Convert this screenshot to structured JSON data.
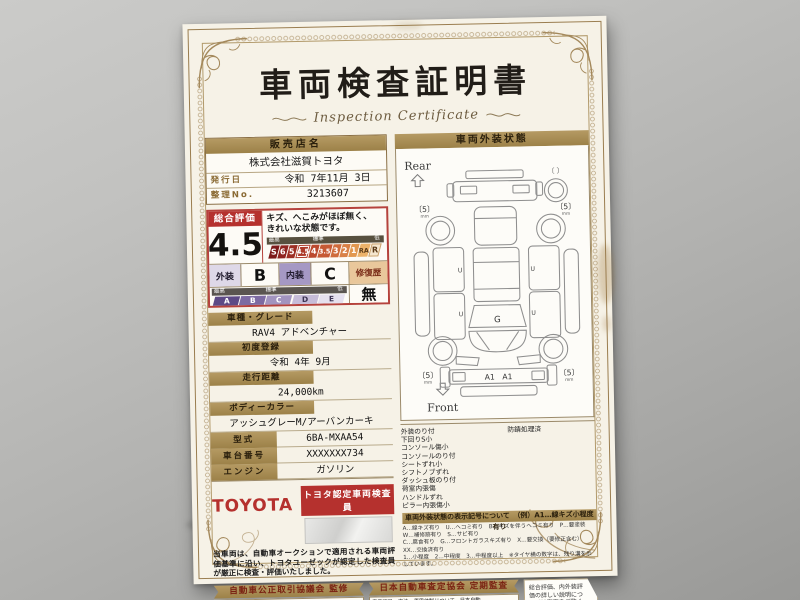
{
  "doc": {
    "title": "車両検査証明書",
    "subtitle": "Inspection Certificate",
    "seller": {
      "header": "販売店名",
      "name": "株式会社滋賀トヨタ",
      "issue_label": "発行日",
      "issue_value": "令和 7年11月 3日",
      "number_label": "整理No.",
      "number_value": "3213607"
    },
    "rating": {
      "label": "総合評価",
      "score": "4.5",
      "comment_line1": "キズ、へこみがほぼ無く、",
      "comment_line2": "きれいな状態です。",
      "scale_top_labels": [
        "最高",
        "標準",
        "低"
      ],
      "scale_cells": [
        "S",
        "6",
        "5",
        "4.5",
        "4",
        "3.5",
        "3",
        "2",
        "1",
        "RA",
        "R"
      ],
      "selected_score": "4.5",
      "exterior_label": "外装",
      "exterior_value": "B",
      "interior_label": "内装",
      "interior_value": "C",
      "repair_label": "修復歴",
      "repair_value": "無",
      "grade_top_labels": [
        "最高",
        "標準",
        "低"
      ],
      "grade_cells": [
        "A",
        "B",
        "C",
        "D",
        "E"
      ]
    },
    "fields": [
      {
        "label": "車種・グレード",
        "value": "RAV4 アドベンチャー"
      },
      {
        "label": "初度登録",
        "value": "令和 4年 9月"
      },
      {
        "label": "走行距離",
        "value": "24,000km"
      },
      {
        "label": "ボディーカラー",
        "value": "アッシュグレーM/アーバンカーキ"
      },
      {
        "label": "型式",
        "value": "6BA-MXAA54"
      },
      {
        "label": "車台番号",
        "value": "XXXXXXX734"
      },
      {
        "label": "エンジン",
        "value": "ガソリン"
      }
    ],
    "certify": {
      "brand": "TOYOTA",
      "badge": "トヨタ認定車両検査員",
      "note": "当車両は、自動車オークションで適用される車両評価基準に沿い、トヨタユーゼックが認定した検査員が厳正に検査・評価いたしました。"
    },
    "exterior_panel": {
      "header": "車両外装状態",
      "rear_label": "Rear",
      "front_label": "Front",
      "tire_depth": "〔5〕",
      "tire_unit": "mm",
      "spare_bracket": "〔 〕",
      "marks": {
        "windshield": "G",
        "front_bumper": "A1　A1",
        "door": "U"
      },
      "notes_left": [
        "外装のり付",
        "下回りS小",
        "コンソール傷小",
        "コンソールのり付",
        "シートずれ小",
        "シフトノブずれ",
        "ダッシュ板のり付",
        "荷室内張傷",
        "ハンドルずれ",
        "ピラー内張傷小"
      ],
      "notes_right": [
        "防錆処理済"
      ],
      "legend_header": "車両外装状態の表示記号について　（例）A1…線キズ小程度有り",
      "legend_lines": [
        "A…線キズ有り　U…ヘコミ有り　B…キズを伴うヘコミ有り　P…要塗装　W…補修跡有り　S…サビ有り",
        "C…腐食有り　G…フロントガラスキズ有り　X…要交換（要修正含む）　XX…交換済有り",
        "1…小程度　2…中程度　3…中程度以上　※タイヤ横の数字は、残り溝を示しています。"
      ]
    },
    "footer": {
      "left": {
        "ribbon": "自動車公正取引協議会 監修",
        "text": "本書は、表示項目・方法・運用体制について、自動車公正取引協議会の定める基準を満たした「トヨタU-Car品質評価制度」に基づき作成しております。"
      },
      "right": {
        "ribbon": "日本自動車査定協会 定期監査",
        "text": "表示項目・方法・運用体制について、日本自動車査定協会による監査を定期的に実施しています。",
        "logo": "JAAI"
      },
      "backside_note": "総合評価、内外装評価の詳しい説明については裏面をご覧ください。"
    }
  }
}
